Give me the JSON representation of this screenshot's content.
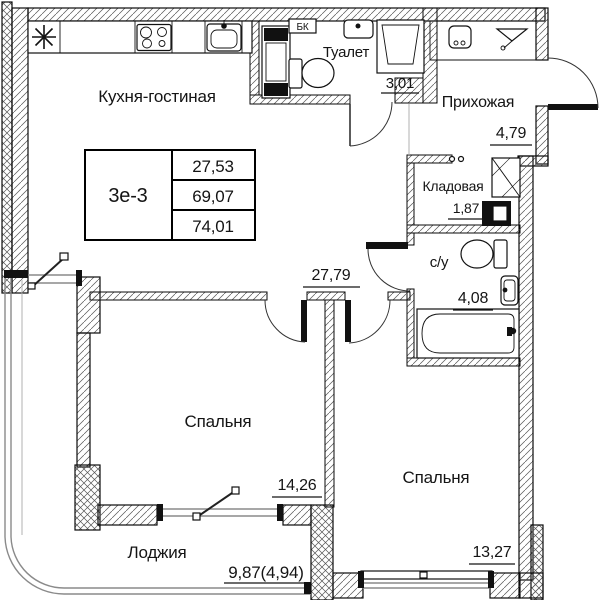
{
  "floorplan": {
    "unit": {
      "id": "3е-3",
      "stats": [
        "27,53",
        "69,07",
        "74,01"
      ]
    },
    "rooms": {
      "kitchen_living": {
        "name": "Кухня-гостиная",
        "area": "27,79"
      },
      "toilet": {
        "name": "Туалет",
        "area": "3,01"
      },
      "hallway": {
        "name": "Прихожая",
        "area": "4,79"
      },
      "storage": {
        "name": "Кладовая",
        "area": "1,87"
      },
      "bathroom": {
        "name": "с/у",
        "area": "4,08"
      },
      "bedroom1": {
        "name": "Спальня",
        "area": "14,26"
      },
      "bedroom2": {
        "name": "Спальня",
        "area": "13,27"
      },
      "loggia": {
        "name": "Лоджия",
        "area": "9,87(4,94)"
      }
    },
    "annotations": {
      "ac_unit": "БК"
    }
  }
}
